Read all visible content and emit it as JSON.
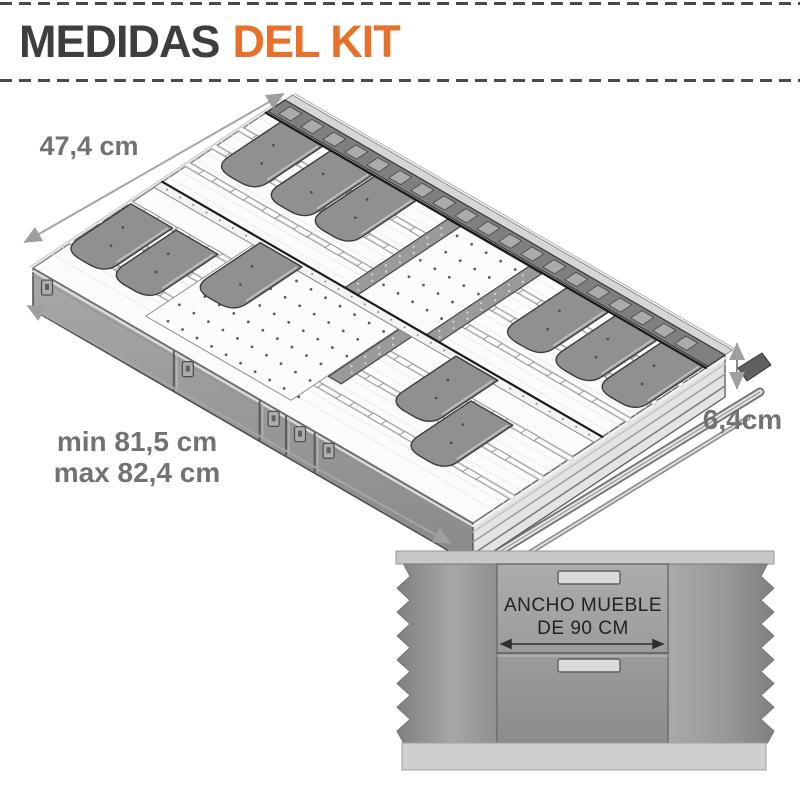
{
  "header": {
    "title_primary": "MEDIDAS",
    "title_accent": "DEL KIT"
  },
  "drawer_dimensions": {
    "depth_label": "47,4 cm",
    "width_min_label": "min 81,5 cm",
    "width_max_label": "max 82,4 cm",
    "height_label": "6,4cm"
  },
  "cabinet": {
    "width_note_line1": "ANCHO MUEBLE",
    "width_note_line2": "DE 90 CM"
  },
  "colors": {
    "accent_orange": "#E7702B",
    "title_gray": "#3E3E40",
    "dimension_text_gray": "#717176",
    "dimension_line_gray": "#9F9F9F",
    "drawing_gray": "#8F8F8F",
    "cabinet_body_gray": "#9A9A9A",
    "cabinet_text": "#222222"
  }
}
